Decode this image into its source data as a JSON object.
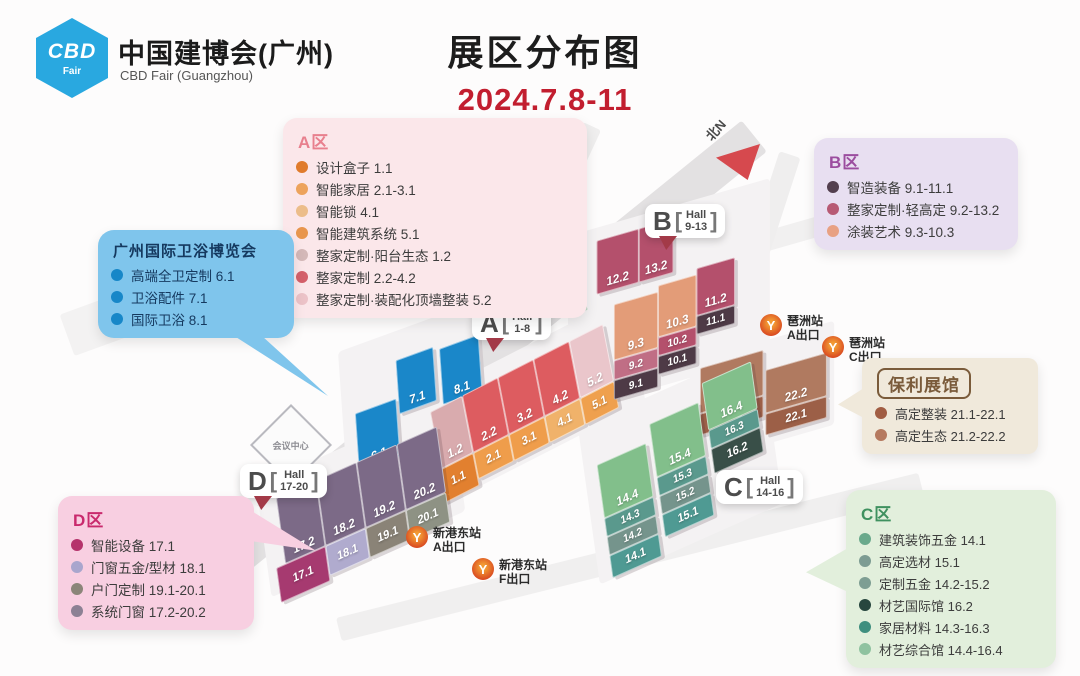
{
  "header": {
    "logo_badge_top": "CBD",
    "logo_badge_bottom": "Fair",
    "org_cn": "中国建博会(广州)",
    "org_en": "CBD Fair (Guangzhou)",
    "title": "展区分布图",
    "dates": "2024.7.8-11",
    "dates_color": "#c21e2f",
    "logo_color": "#29a8e0"
  },
  "north_label": "北N",
  "landmark_label": "会议中心",
  "metro_icon_glyph": "Y",
  "hall_badges": [
    {
      "id": "A",
      "letter": "A",
      "line1": "Hall",
      "line2": "1-8",
      "pointer": true
    },
    {
      "id": "B",
      "letter": "B",
      "line1": "Hall",
      "line2": "9-13",
      "pointer": true
    },
    {
      "id": "C",
      "letter": "C",
      "line1": "Hall",
      "line2": "14-16",
      "pointer": false
    },
    {
      "id": "D",
      "letter": "D",
      "line1": "Hall",
      "line2": "17-20",
      "pointer": true
    }
  ],
  "metro_stations": [
    {
      "id": "pazhou-exit-a",
      "name": "琶洲站",
      "exit": "A出口"
    },
    {
      "id": "pazhou-exit-c",
      "name": "琶洲站",
      "exit": "C出口"
    },
    {
      "id": "xingangdong-exit-a",
      "name": "新港东站",
      "exit": "A出口"
    },
    {
      "id": "xingangdong-exit-f",
      "name": "新港东站",
      "exit": "F出口"
    }
  ],
  "legend_boxes": [
    {
      "id": "a",
      "title": "A区",
      "title_color": "#e8808e",
      "bg": "#fbe7ea",
      "items": [
        {
          "label": "设计盒子",
          "halls": "1.1",
          "color": "#e07b2c"
        },
        {
          "label": "智能家居",
          "halls": "2.1-3.1",
          "color": "#eda35c"
        },
        {
          "label": "智能锁",
          "halls": "4.1",
          "color": "#ecbd8a"
        },
        {
          "label": "智能建筑系统",
          "halls": "5.1",
          "color": "#e8954d"
        },
        {
          "label": "整家定制·阳台生态",
          "halls": "1.2",
          "color": "#d4b8b8"
        },
        {
          "label": "整家定制",
          "halls": "2.2-4.2",
          "color": "#d4606a"
        },
        {
          "label": "整家定制·装配化顶墙整装",
          "halls": "5.2",
          "color": "#ecc3c8"
        }
      ]
    },
    {
      "id": "b",
      "title": "B区",
      "title_color": "#9b4d9f",
      "bg": "#e8dff1",
      "items": [
        {
          "label": "智造装备",
          "halls": "9.1-11.1",
          "color": "#533f4e"
        },
        {
          "label": "整家定制·轻高定",
          "halls": "9.2-13.2",
          "color": "#b75a74"
        },
        {
          "label": "涂装艺术",
          "halls": "9.3-10.3",
          "color": "#e8a183"
        }
      ]
    },
    {
      "id": "bath",
      "title": "广州国际卫浴博览会",
      "title_color": "#15395f",
      "bg": "#7fc5ec",
      "items": [
        {
          "label": "高端全卫定制",
          "halls": "6.1",
          "color": "#1787c8"
        },
        {
          "label": "卫浴配件",
          "halls": "7.1",
          "color": "#1787c8"
        },
        {
          "label": "国际卫浴",
          "halls": "8.1",
          "color": "#1787c8"
        }
      ]
    },
    {
      "id": "poly",
      "title": "保利展馆",
      "title_color": "#7a5b3a",
      "bg": "#f0e9db",
      "boxed_title": true,
      "items": [
        {
          "label": "高定整装",
          "halls": "21.1-22.1",
          "color": "#a15d43"
        },
        {
          "label": "高定生态",
          "halls": "21.2-22.2",
          "color": "#b5795f"
        }
      ]
    },
    {
      "id": "d",
      "title": "D区",
      "title_color": "#c92a6d",
      "bg": "#f8cfe1",
      "items": [
        {
          "label": "智能设备",
          "halls": "17.1",
          "color": "#b5336b"
        },
        {
          "label": "门窗五金/型材",
          "halls": "18.1",
          "color": "#a9a6cd"
        },
        {
          "label": "户门定制",
          "halls": "19.1-20.1",
          "color": "#8b8579"
        },
        {
          "label": "系统门窗",
          "halls": "17.2-20.2",
          "color": "#8c8194"
        }
      ]
    },
    {
      "id": "c",
      "title": "C区",
      "title_color": "#3f915f",
      "bg": "#e2efdc",
      "items": [
        {
          "label": "建筑装饰五金",
          "halls": "14.1",
          "color": "#6aa98c"
        },
        {
          "label": "高定选材",
          "halls": "15.1",
          "color": "#7d9c93"
        },
        {
          "label": "定制五金",
          "halls": "14.2-15.2",
          "color": "#7e9e93"
        },
        {
          "label": "材艺国际馆",
          "halls": "16.2",
          "color": "#27463e"
        },
        {
          "label": "家居材料",
          "halls": "14.3-16.3",
          "color": "#3f8f7f"
        },
        {
          "label": "材艺综合馆",
          "halls": "14.4-16.4",
          "color": "#8fc2a0"
        }
      ]
    }
  ],
  "map_halls": {
    "clusters": [
      {
        "id": "bath",
        "blocks": [
          {
            "id": "6.1",
            "color": "#1a87c9"
          },
          {
            "id": "7.1",
            "color": "#1a87c9"
          },
          {
            "id": "8.1",
            "color": "#1a87c9"
          }
        ]
      },
      {
        "id": "a",
        "blocks": [
          {
            "id": "1.2",
            "color": "#d9abae"
          },
          {
            "id": "2.2",
            "color": "#dd5c60"
          },
          {
            "id": "3.2",
            "color": "#dd5c60"
          },
          {
            "id": "4.2",
            "color": "#dd5c60"
          },
          {
            "id": "5.2",
            "color": "#eac6cb"
          },
          {
            "id": "1.1",
            "color": "#e2802f"
          },
          {
            "id": "2.1",
            "color": "#ef9d4b"
          },
          {
            "id": "3.1",
            "color": "#ef9d4b"
          },
          {
            "id": "4.1",
            "color": "#f0b26a"
          },
          {
            "id": "5.1",
            "color": "#efa04e"
          }
        ]
      },
      {
        "id": "b",
        "blocks": [
          {
            "id": "12.2",
            "color": "#b4506c"
          },
          {
            "id": "13.2",
            "color": "#b4506c"
          },
          {
            "id": "9.3",
            "color": "#e39c78"
          },
          {
            "id": "10.3",
            "color": "#e39c78"
          },
          {
            "id": "11.2",
            "color": "#b4506c"
          },
          {
            "id": "9.2",
            "color": "#c06e85"
          },
          {
            "id": "10.2",
            "color": "#b4506c"
          },
          {
            "id": "11.1",
            "color": "#4e3a46"
          },
          {
            "id": "9.1",
            "color": "#4e3a46"
          },
          {
            "id": "10.1",
            "color": "#4e3a46"
          }
        ]
      },
      {
        "id": "poly",
        "blocks": [
          {
            "id": "21.2",
            "color": "#b07a60"
          },
          {
            "id": "21.1",
            "color": "#9c5f47"
          },
          {
            "id": "22.2",
            "color": "#b07a60"
          },
          {
            "id": "22.1",
            "color": "#9c5f47"
          }
        ]
      },
      {
        "id": "c",
        "blocks": [
          {
            "id": "14.4",
            "color": "#82bf8b"
          },
          {
            "id": "14.3",
            "color": "#5a998d"
          },
          {
            "id": "14.2",
            "color": "#75948c"
          },
          {
            "id": "14.1",
            "color": "#4f9a93"
          },
          {
            "id": "15.4",
            "color": "#82bf8b"
          },
          {
            "id": "15.3",
            "color": "#5a998d"
          },
          {
            "id": "15.2",
            "color": "#75948c"
          },
          {
            "id": "15.1",
            "color": "#4f9a93"
          },
          {
            "id": "16.4",
            "color": "#82bf8b"
          },
          {
            "id": "16.3",
            "color": "#5a998d"
          },
          {
            "id": "16.2",
            "color": "#394f48"
          }
        ]
      },
      {
        "id": "d",
        "blocks": [
          {
            "id": "17.2",
            "color": "#7c6a87"
          },
          {
            "id": "18.2",
            "color": "#7c6a87"
          },
          {
            "id": "19.2",
            "color": "#7c6a87"
          },
          {
            "id": "20.2",
            "color": "#7c6a87"
          },
          {
            "id": "17.1",
            "color": "#a63a70"
          },
          {
            "id": "18.1",
            "color": "#b0abce"
          },
          {
            "id": "19.1",
            "color": "#8a8377"
          },
          {
            "id": "20.1",
            "color": "#8e9284"
          }
        ]
      }
    ]
  }
}
